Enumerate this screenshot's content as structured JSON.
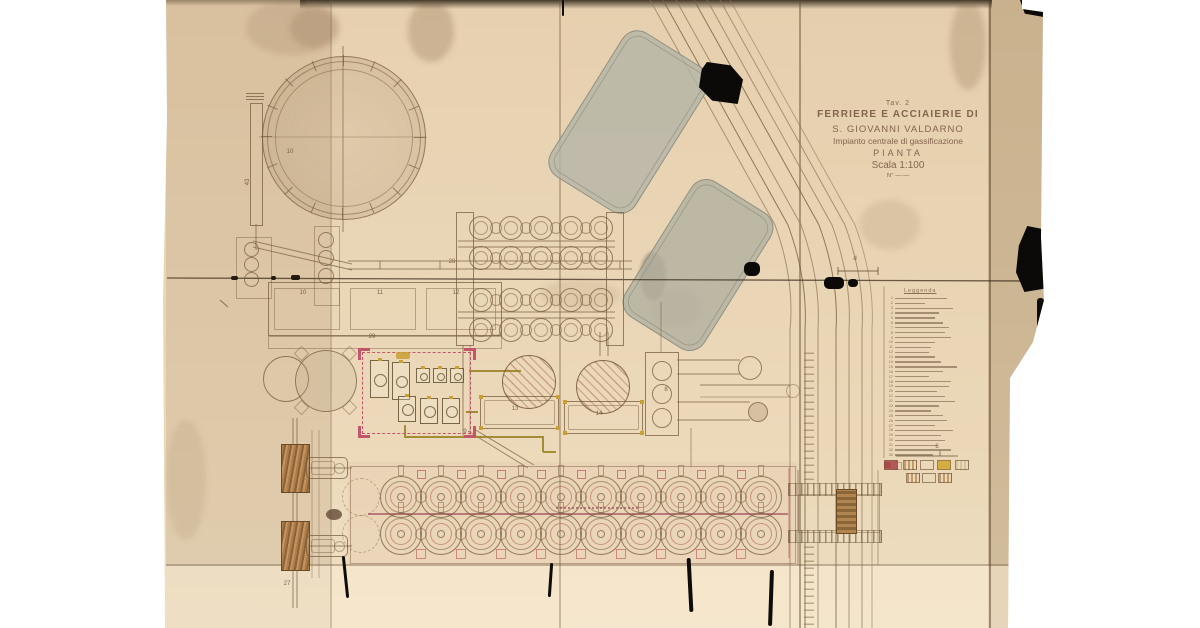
{
  "title_block": {
    "tav": "Tav. 2",
    "line1": "FERRIERE E ACCIAIERIE DI",
    "line2": "S. GIOVANNI VALDARNO",
    "line3": "Impianto centrale di gassificazione",
    "line4": "PIANTA",
    "line5": "Scala 1:100",
    "note": "N° —·—"
  },
  "legend": {
    "header": "Leggenda",
    "items": [
      {
        "n": "1",
        "w": 52
      },
      {
        "n": "2",
        "w": 30
      },
      {
        "n": "3",
        "w": 58
      },
      {
        "n": "4",
        "w": 44
      },
      {
        "n": "5",
        "w": 40
      },
      {
        "n": "6",
        "w": 48
      },
      {
        "n": "7",
        "w": 54
      },
      {
        "n": "8",
        "w": 50
      },
      {
        "n": "9",
        "w": 56
      },
      {
        "n": "10",
        "w": 40
      },
      {
        "n": "11",
        "w": 36
      },
      {
        "n": "12",
        "w": 34
      },
      {
        "n": "13",
        "w": 40
      },
      {
        "n": "14",
        "w": 46
      },
      {
        "n": "15",
        "w": 62
      },
      {
        "n": "16",
        "w": 48
      },
      {
        "n": "17",
        "w": 34
      },
      {
        "n": "18",
        "w": 56
      },
      {
        "n": "19",
        "w": 54
      },
      {
        "n": "20",
        "w": 42
      },
      {
        "n": "21",
        "w": 50
      },
      {
        "n": "22",
        "w": 60
      },
      {
        "n": "23",
        "w": 44
      },
      {
        "n": "24",
        "w": 36
      },
      {
        "n": "25",
        "w": 48
      },
      {
        "n": "26",
        "w": 52
      },
      {
        "n": "27",
        "w": 40
      },
      {
        "n": "28",
        "w": 58
      },
      {
        "n": "29",
        "w": 46
      },
      {
        "n": "30",
        "w": 50
      },
      {
        "n": "31",
        "w": 42
      },
      {
        "n": "32",
        "w": 56
      },
      {
        "n": "33",
        "w": 38
      }
    ]
  },
  "swatch_key": {
    "label": "6",
    "row1": [
      {
        "style": "solid",
        "color": "#a84848"
      },
      {
        "style": "hatch",
        "color": "#c49a6a"
      },
      {
        "style": "outline",
        "color": "#b59a74"
      },
      {
        "style": "solid",
        "color": "#d2a62e"
      },
      {
        "style": "hatch",
        "color": "#d8c49c"
      }
    ],
    "row2": [
      {
        "style": "hatch",
        "color": "#c49a6a"
      },
      {
        "style": "outline",
        "color": "#b59a74"
      },
      {
        "style": "hatch",
        "color": "#c49a6a"
      }
    ]
  },
  "annotations": [
    {
      "text": "10",
      "x": 290,
      "y": 152
    },
    {
      "text": "43",
      "x": 248,
      "y": 182,
      "rot": -90
    },
    {
      "text": "28",
      "x": 452,
      "y": 262
    },
    {
      "text": "10",
      "x": 303,
      "y": 293
    },
    {
      "text": "11",
      "x": 380,
      "y": 293
    },
    {
      "text": "12",
      "x": 456,
      "y": 293
    },
    {
      "text": "29",
      "x": 372,
      "y": 337
    },
    {
      "text": "9",
      "x": 465,
      "y": 432
    },
    {
      "text": "13",
      "x": 515,
      "y": 409
    },
    {
      "text": "14",
      "x": 599,
      "y": 414
    },
    {
      "text": "8",
      "x": 666,
      "y": 390
    },
    {
      "text": "27",
      "x": 287,
      "y": 584
    },
    {
      "text": "d",
      "x": 855,
      "y": 259
    },
    {
      "text": "6",
      "x": 937,
      "y": 447
    }
  ],
  "plant_features": {
    "gas_holder_count": 1,
    "gasifier_grid": {
      "rows": 4,
      "cols": 5
    },
    "oven_battery": {
      "rows": 2,
      "cols": 10
    },
    "settling_basins": 2
  },
  "colors": {
    "paper": "#e8d4b4",
    "ink": "#7a5e40",
    "red_outline": "#c4566a",
    "yellow_pipe": "#c9a032",
    "magenta_line": "#9c3f58",
    "pond": "#b4b4a6",
    "tear": "#0b0a08"
  }
}
